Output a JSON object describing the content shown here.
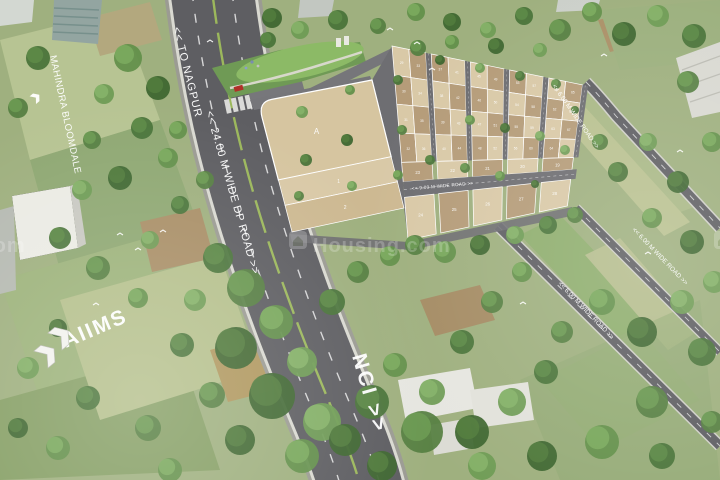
{
  "watermark": {
    "brand": "Housing.com",
    "icon": "house-icon"
  },
  "roads": {
    "to_nagpur": "<< TO NAGPUR",
    "dp_road": "<< 24.00 M WIDE DP ROAD >>",
    "nci": "NCI >>",
    "road_9m": "<< 9.00 M WIDE ROAD >>",
    "road_6m": "<< 6.00 M WIDE ROAD >>"
  },
  "landmarks": {
    "mahindra": "MAHINDRA BLOOMDALE",
    "aiims": "AIIMS"
  },
  "plots": {
    "big": "A",
    "left": [
      "1",
      "2"
    ],
    "above_9m": [
      "23",
      "22",
      "21",
      "20",
      "19"
    ],
    "below_9m": [
      "24",
      "25",
      "26",
      "27",
      "28"
    ],
    "grid_start": 29,
    "grid_count": 40
  },
  "colors": {
    "plot_light": "#d9c9a7",
    "plot_dark": "#b59c79",
    "plot_big": "#d6c5a0",
    "road": "#5e5e62",
    "internal_road": "#6e6e72",
    "median_green": "#9cb85c",
    "label_text": "#ffffff"
  }
}
